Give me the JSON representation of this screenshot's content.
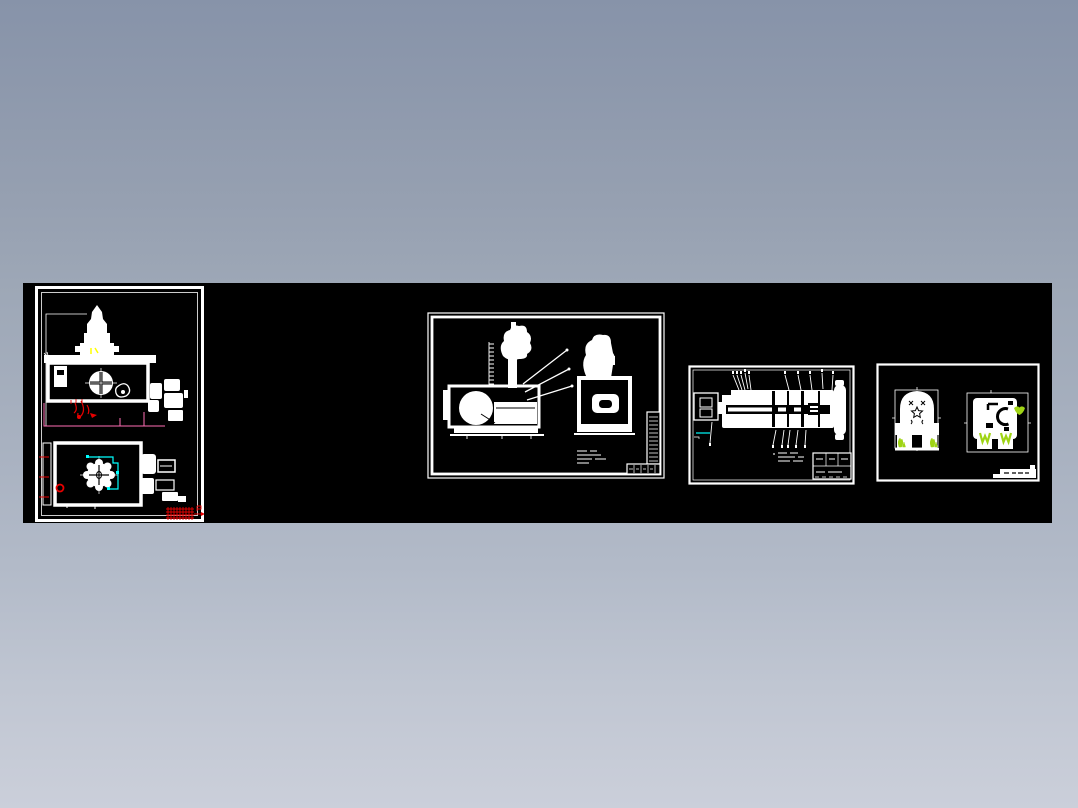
{
  "page": {
    "description": "Preview strip of four white-on-black CAD engineering sheets over a blue-gray gradient background",
    "background": {
      "top": "#8793a9",
      "middle": "#a8b1c0",
      "bottom": "#cbcfda"
    },
    "strip": {
      "background": "#000000",
      "left": 23,
      "top": 283,
      "width": 1029,
      "height": 240
    }
  },
  "colors": {
    "white": "#ffffff",
    "black": "#000000",
    "red": "#e80000",
    "magenta": "#ff6eb4",
    "cyan": "#00ffff",
    "yellow": "#ffff00",
    "green": "#9fd414"
  },
  "sheets": [
    {
      "name": "sheet-1",
      "orientation": "portrait",
      "views": [
        "front-view-with-tower-and-handwheel",
        "plan-view-with-gear"
      ],
      "accents": [
        "red",
        "magenta",
        "cyan",
        "yellow"
      ],
      "title_block_note": "red hatched stamp, text illegible"
    },
    {
      "name": "sheet-2",
      "orientation": "landscape",
      "views": [
        "side-view-with-column",
        "end-view-with-slot"
      ],
      "accents": [],
      "title_block_note": "stepped parts list, text illegible"
    },
    {
      "name": "sheet-3",
      "orientation": "landscape",
      "views": [
        "shaft-assembly-with-leader-callouts"
      ],
      "accents": [
        "cyan"
      ],
      "title_block_note": "small table, text illegible"
    },
    {
      "name": "sheet-4",
      "orientation": "landscape",
      "views": [
        "dome-body-front",
        "square-body-side"
      ],
      "accents": [
        "green"
      ],
      "title_block_note": "white strip, text illegible"
    }
  ]
}
